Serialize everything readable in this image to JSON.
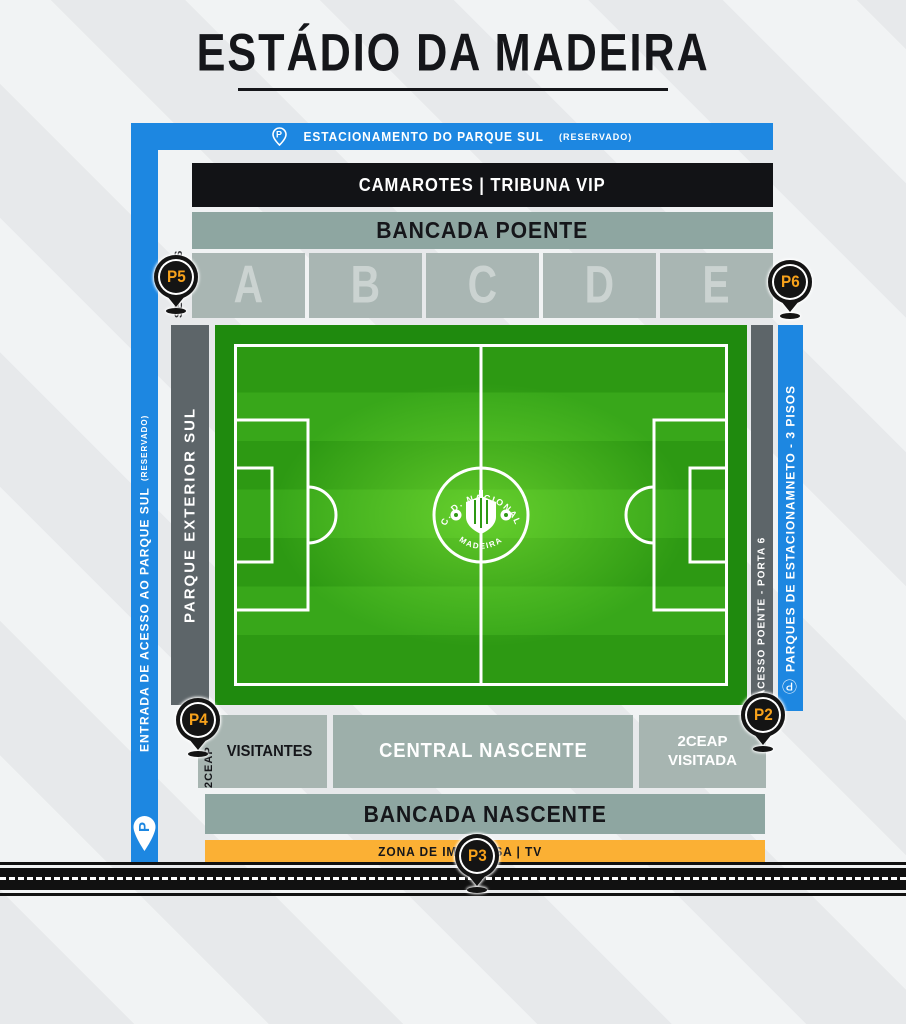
{
  "title": "ESTÁDIO DA MADEIRA",
  "top_bar": {
    "label": "ESTACIONAMENTO DO PARQUE SUL",
    "note": "(RESERVADO)"
  },
  "left_blue_bar": {
    "label": "ENTRADA DE ACESSO AO PARQUE SUL",
    "note": "(RESERVADO)"
  },
  "camarotes_bar": {
    "label": "CAMAROTES | TRIBUNA VIP"
  },
  "bancada_poente": {
    "label": "BANCADA POENTE"
  },
  "sectors": {
    "label": "SECTORES",
    "items": [
      "A",
      "B",
      "C",
      "D",
      "E"
    ]
  },
  "parque_exterior": {
    "label": "PARQUE EXTERIOR SUL"
  },
  "acesso_poente": {
    "label": "ACESSO POENTE - PORTA 6"
  },
  "right_blue_bar": {
    "label": "PARQUES DE ESTACIONAMNETO - 3 PISOS"
  },
  "pitch_logo": {
    "club_top": "C. D. NACIONAL",
    "club_bottom": "MADEIRA"
  },
  "south_row": {
    "twoceap_label": "2CEAP",
    "visitantes": "VISITANTES",
    "central": "CENTRAL NASCENTE",
    "visitada_line1": "2CEAP",
    "visitada_line2": "VISITADA"
  },
  "bancada_nascente": {
    "label": "BANCADA NASCENTE"
  },
  "press_bar": {
    "label": "ZONA DE IMPRENSA | TV"
  },
  "pins": {
    "p2": "P2",
    "p3": "P3",
    "p4": "P4",
    "p5": "P5",
    "p6": "P6"
  },
  "colors": {
    "blue": "#1d87e1",
    "sage": "#8ea6a1",
    "sector_gray": "#a9b6b3",
    "dark_gray": "#5d6569",
    "orange_bar": "#fbb034",
    "pin_text_orange": "#f7a21b",
    "pitch_dark_green": "#1f8a0e",
    "pitch_stripe_green": "#38a71a",
    "black": "#121316"
  }
}
